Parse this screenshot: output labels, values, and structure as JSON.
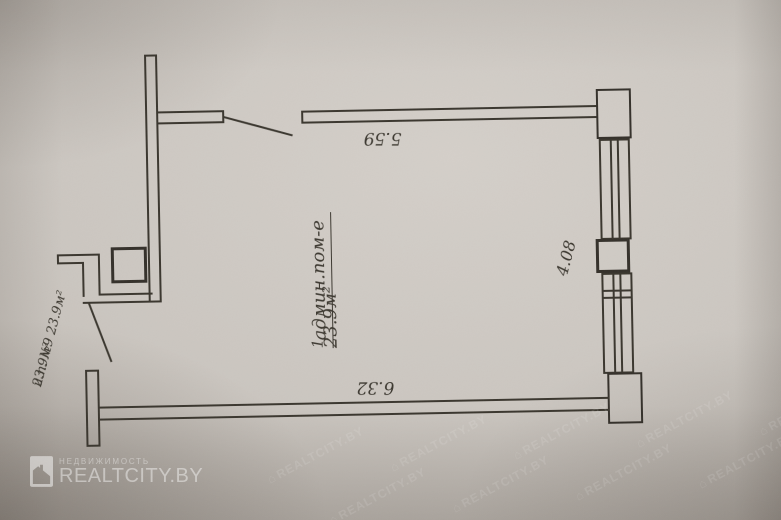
{
  "plan": {
    "room_number": "1",
    "room_name": "админ.пом-е",
    "room_area": "23.9м²",
    "dim_top": "5.59",
    "dim_bottom": "6.32",
    "dim_right": "4.08",
    "unit_label": "и.п. №9 23.9м²",
    "unit_area": "23.9м²"
  },
  "watermark": {
    "category": "НЕДВИЖИМОСТЬ",
    "brand": "REALTCITY.BY",
    "tile_text": "REALTCITY.BY",
    "tile_house_glyph": "⌂"
  },
  "colors": {
    "paper": "#cbc6c0",
    "ink": "#3a362e",
    "watermark": "#ffffff"
  }
}
